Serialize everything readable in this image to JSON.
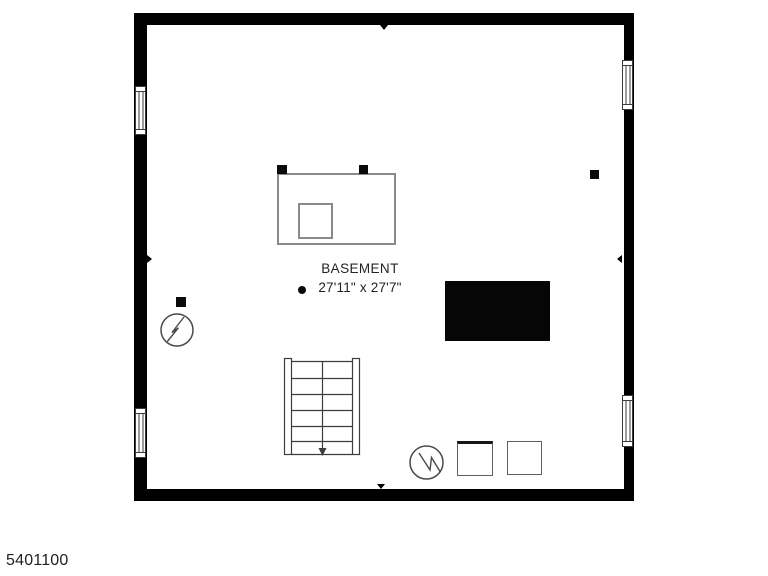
{
  "room": {
    "label": "BASEMENT",
    "dimensions": "27'11\" x 27'7\""
  },
  "footer": {
    "id": "5401100"
  },
  "colors": {
    "wall": "#000000",
    "equipment_outline": "#8a8a8a",
    "stairs_stroke": "#3d3d3d",
    "symbol_stroke": "#4a4a4a",
    "slab_fill": "#060606",
    "text": "#232323"
  },
  "icons": {
    "utility_left": "circle-lightning-icon",
    "utility_bottom": "circle-lightning-icon",
    "stairs": "staircase-down-icon"
  }
}
